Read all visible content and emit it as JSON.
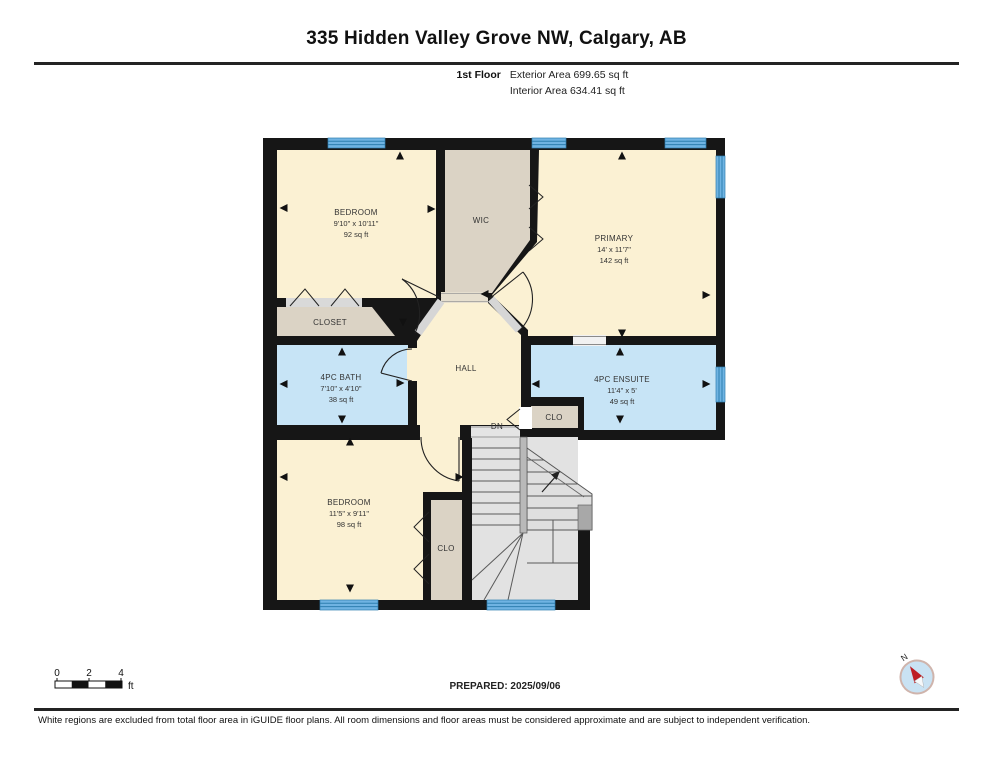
{
  "header": {
    "title": "335 Hidden Valley Grove NW, Calgary, AB",
    "floor_label": "1st Floor",
    "exterior_area": "Exterior Area 699.65 sq ft",
    "interior_area": "Interior Area 634.41 sq ft"
  },
  "rooms": {
    "bedroom1": {
      "name": "BEDROOM",
      "dims": "9'10\" x 10'11\"",
      "area": "92 sq ft"
    },
    "wic": {
      "name": "WIC"
    },
    "primary": {
      "name": "PRIMARY",
      "dims": "14' x 11'7\"",
      "area": "142 sq ft"
    },
    "closet": {
      "name": "CLOSET"
    },
    "bath": {
      "name": "4PC BATH",
      "dims": "7'10\" x 4'10\"",
      "area": "38 sq ft"
    },
    "hall": {
      "name": "HALL"
    },
    "ensuite": {
      "name": "4PC ENSUITE",
      "dims": "11'4\" x 5'",
      "area": "49 sq ft"
    },
    "clo_upper": {
      "name": "CLO"
    },
    "bedroom2": {
      "name": "BEDROOM",
      "dims": "11'5\" x 9'11\"",
      "area": "98 sq ft"
    },
    "clo_lower": {
      "name": "CLO"
    },
    "stairs": {
      "label": "DN"
    }
  },
  "footer": {
    "scale": {
      "ticks": [
        "0",
        "2",
        "4"
      ],
      "unit": "ft"
    },
    "prepared": "PREPARED: 2025/09/06",
    "compass": "N",
    "disclaimer": "White regions are excluded from total floor area in iGUIDE floor plans. All room dimensions and floor areas must be considered approximate and are subject to independent verification."
  },
  "colors": {
    "wall": "#161616",
    "room": "#FBF1D3",
    "closet": "#DBD3C5",
    "wet_room": "#C7E4F6",
    "window": "#6FB3E2",
    "stairs": "#E2E2E2"
  }
}
